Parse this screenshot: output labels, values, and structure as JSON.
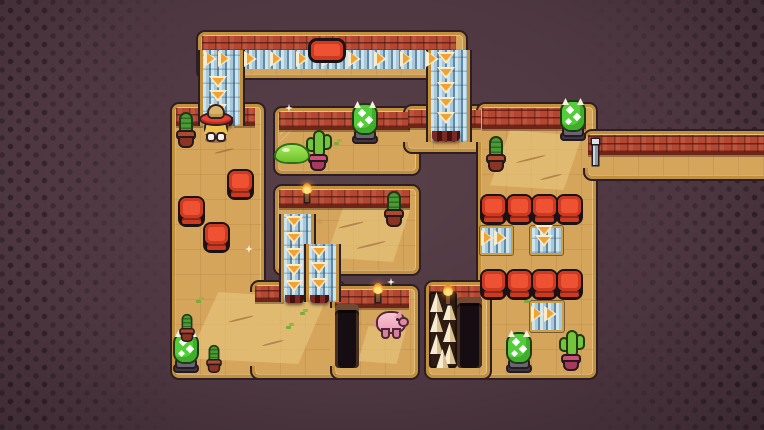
{
  "scene": {
    "width": 764,
    "height": 430
  },
  "colors": {
    "bg": "#4e3741",
    "outline": "#2c1d27",
    "gold": "#c0903c",
    "sand": "#d6a55c",
    "sandLight": "#e8c67f",
    "brick": "#b34731",
    "beltBg": "#a9c9da",
    "beltLight": "#cfe5ee",
    "beltDark": "#5f89a4",
    "arrow": "#f2a232",
    "arrowEdge": "#f8eccd",
    "crate": "#ef5233",
    "crateMid": "#cd3a22",
    "crateLine": "#1c1216"
  },
  "level": {
    "floors": [
      {
        "name": "top-bar",
        "x": 198,
        "y": 32,
        "w": 262,
        "h": 40
      },
      {
        "name": "left-room",
        "x": 172,
        "y": 104,
        "w": 86,
        "h": 268
      },
      {
        "name": "bottom-ext",
        "x": 252,
        "y": 282,
        "w": 86,
        "h": 90
      },
      {
        "name": "slime-room",
        "x": 275,
        "y": 108,
        "w": 138,
        "h": 60
      },
      {
        "name": "arm-corridor",
        "x": 405,
        "y": 106,
        "w": 80,
        "h": 40
      },
      {
        "name": "lower-mid-room",
        "x": 275,
        "y": 186,
        "w": 138,
        "h": 82
      },
      {
        "name": "pig-room",
        "x": 332,
        "y": 286,
        "w": 80,
        "h": 86
      },
      {
        "name": "right-room",
        "x": 478,
        "y": 104,
        "w": 112,
        "h": 268
      },
      {
        "name": "spike-section",
        "x": 426,
        "y": 282,
        "w": 58,
        "h": 90
      },
      {
        "name": "east-corridor",
        "x": 585,
        "y": 131,
        "w": 181,
        "h": 42
      }
    ],
    "patches": [
      {
        "x": 249,
        "y": 292,
        "w": 12,
        "h": 74
      },
      {
        "x": 330,
        "y": 308,
        "w": 10,
        "h": 58
      },
      {
        "x": 403,
        "y": 114,
        "w": 12,
        "h": 28
      },
      {
        "x": 476,
        "y": 126,
        "w": 12,
        "h": 16
      },
      {
        "x": 476,
        "y": 306,
        "w": 10,
        "h": 60
      },
      {
        "x": 583,
        "y": 136,
        "w": 12,
        "h": 32
      }
    ],
    "bricks": [
      {
        "x": 202,
        "y": 36,
        "w": 254,
        "h": 15
      },
      {
        "x": 176,
        "y": 108,
        "w": 27,
        "h": 15
      },
      {
        "x": 234,
        "y": 108,
        "w": 21,
        "h": 15
      },
      {
        "x": 279,
        "y": 112,
        "w": 131,
        "h": 15
      },
      {
        "x": 408,
        "y": 110,
        "w": 24,
        "h": 15
      },
      {
        "x": 461,
        "y": 110,
        "w": 20,
        "h": 15
      },
      {
        "x": 482,
        "y": 108,
        "w": 104,
        "h": 18
      },
      {
        "x": 279,
        "y": 190,
        "w": 131,
        "h": 15
      },
      {
        "x": 255,
        "y": 286,
        "w": 29,
        "h": 13
      },
      {
        "x": 335,
        "y": 290,
        "w": 74,
        "h": 15
      },
      {
        "x": 429,
        "y": 286,
        "w": 52,
        "h": 14
      },
      {
        "x": 588,
        "y": 135,
        "w": 176,
        "h": 17
      }
    ],
    "belts": [
      {
        "name": "belt-top",
        "x": 201,
        "y": 50,
        "w": 256,
        "h": 19,
        "dir": "right",
        "frame": "none",
        "arrows": [
          [
            210,
            59
          ],
          [
            224,
            59
          ],
          [
            250,
            59
          ],
          [
            276,
            59
          ],
          [
            302,
            59
          ],
          [
            328,
            59
          ],
          [
            354,
            59
          ],
          [
            380,
            59
          ],
          [
            406,
            59
          ],
          [
            432,
            59
          ]
        ]
      },
      {
        "name": "belt-left-col",
        "x": 200,
        "y": 50,
        "w": 37,
        "h": 76,
        "dir": "down",
        "frame": "rails",
        "arrows": [
          [
            218,
            82
          ],
          [
            218,
            96
          ],
          [
            218,
            110
          ]
        ],
        "cap": {
          "x": 204,
          "y": 117,
          "w": 29,
          "h": 9
        }
      },
      {
        "name": "belt-right-col",
        "x": 428,
        "y": 50,
        "w": 36,
        "h": 92,
        "dir": "down",
        "frame": "rails",
        "arrows": [
          [
            446,
            58
          ],
          [
            446,
            73
          ],
          [
            446,
            88
          ],
          [
            446,
            103
          ],
          [
            446,
            118
          ]
        ],
        "cap": {
          "x": 432,
          "y": 131,
          "w": 28,
          "h": 10
        }
      },
      {
        "name": "belt-mid-left",
        "x": 281,
        "y": 214,
        "w": 27,
        "h": 88,
        "dir": "down",
        "frame": "rails",
        "arrows": [
          [
            294,
            222
          ],
          [
            294,
            238
          ],
          [
            294,
            254
          ],
          [
            294,
            270
          ],
          [
            294,
            286
          ]
        ],
        "cap": {
          "x": 285,
          "y": 295,
          "w": 19,
          "h": 8
        }
      },
      {
        "name": "belt-mid-right",
        "x": 306,
        "y": 244,
        "w": 27,
        "h": 58,
        "dir": "down",
        "frame": "rails",
        "arrows": [
          [
            319,
            252
          ],
          [
            319,
            268
          ],
          [
            319,
            284
          ]
        ],
        "cap": {
          "x": 310,
          "y": 295,
          "w": 19,
          "h": 8
        }
      },
      {
        "name": "belt-r1-right",
        "x": 480,
        "y": 226,
        "w": 29,
        "h": 25,
        "dir": "right",
        "frame": "tile",
        "arrows": [
          [
            487,
            238
          ],
          [
            500,
            238
          ]
        ]
      },
      {
        "name": "belt-r1-down",
        "x": 530,
        "y": 226,
        "w": 29,
        "h": 25,
        "dir": "down",
        "frame": "tile",
        "arrows": [
          [
            544,
            231
          ],
          [
            544,
            241
          ]
        ]
      },
      {
        "name": "belt-r2-right",
        "x": 530,
        "y": 301,
        "w": 30,
        "h": 27,
        "dir": "right",
        "frame": "tile",
        "arrows": [
          [
            537,
            314
          ],
          [
            550,
            314
          ]
        ]
      }
    ],
    "pits": [
      {
        "x": 335,
        "y": 304,
        "w": 24,
        "h": 64
      },
      {
        "x": 457,
        "y": 297,
        "w": 25,
        "h": 71
      }
    ],
    "spikes": {
      "x": 429,
      "y": 292,
      "w": 28,
      "h": 76,
      "cones": [
        [
          1,
          0
        ],
        [
          14,
          8
        ],
        [
          1,
          20
        ],
        [
          14,
          30
        ],
        [
          1,
          42
        ],
        [
          14,
          52
        ],
        [
          7,
          57
        ]
      ]
    },
    "crates": [
      {
        "x": 227,
        "y": 169
      },
      {
        "x": 178,
        "y": 196
      },
      {
        "x": 203,
        "y": 222
      },
      {
        "x": 480,
        "y": 194
      },
      {
        "x": 506,
        "y": 194
      },
      {
        "x": 531,
        "y": 194
      },
      {
        "x": 556,
        "y": 194
      },
      {
        "x": 480,
        "y": 269
      },
      {
        "x": 506,
        "y": 269
      },
      {
        "x": 531,
        "y": 269
      },
      {
        "x": 556,
        "y": 269
      }
    ]
  },
  "entities": [
    {
      "type": "cowboy",
      "x": 200,
      "y": 105
    },
    {
      "type": "cactus",
      "x": 175,
      "y": 112
    },
    {
      "type": "spiky",
      "x": 352,
      "y": 102
    },
    {
      "type": "cactus-arms",
      "x": 306,
      "y": 130
    },
    {
      "type": "slime",
      "x": 276,
      "y": 145
    },
    {
      "type": "cactus",
      "x": 383,
      "y": 191
    },
    {
      "type": "cactus",
      "x": 485,
      "y": 136
    },
    {
      "type": "spiky",
      "x": 560,
      "y": 99
    },
    {
      "type": "pig",
      "x": 377,
      "y": 310
    },
    {
      "type": "spiky",
      "x": 506,
      "y": 331
    },
    {
      "type": "cactus-arms",
      "x": 559,
      "y": 330
    },
    {
      "type": "spiky",
      "x": 173,
      "y": 331
    },
    {
      "type": "cactus",
      "x": 176,
      "y": 306,
      "small": true
    },
    {
      "type": "cactus",
      "x": 203,
      "y": 337,
      "small": true
    }
  ],
  "decor": {
    "button": {
      "x": 308,
      "y": 38,
      "w": 38,
      "h": 25
    },
    "post": {
      "x": 590,
      "y": 139
    },
    "torches": [
      [
        302,
        183
      ],
      [
        373,
        283
      ],
      [
        443,
        285
      ]
    ],
    "sparkles": [
      [
        285,
        104
      ],
      [
        245,
        245
      ],
      [
        387,
        278
      ]
    ],
    "sandpatches": [
      {
        "x": 326,
        "y": 204,
        "w": 84,
        "h": 58
      },
      {
        "x": 490,
        "y": 130,
        "w": 92,
        "h": 60
      },
      {
        "x": 188,
        "y": 292,
        "w": 138,
        "h": 72
      },
      {
        "x": 358,
        "y": 326,
        "w": 48,
        "h": 38
      }
    ],
    "squiggles": [
      [
        338,
        224,
        26
      ],
      [
        356,
        244,
        30
      ],
      [
        516,
        158,
        30
      ],
      [
        228,
        318,
        26
      ],
      [
        262,
        342,
        22
      ],
      [
        540,
        176,
        22
      ],
      [
        214,
        150,
        20
      ]
    ],
    "grass": [
      [
        196,
        300
      ],
      [
        286,
        326
      ],
      [
        334,
        142
      ],
      [
        208,
        358
      ],
      [
        300,
        312
      ],
      [
        524,
        300
      ]
    ],
    "webs": [
      [
        280,
        128
      ],
      [
        282,
        194
      ]
    ]
  }
}
